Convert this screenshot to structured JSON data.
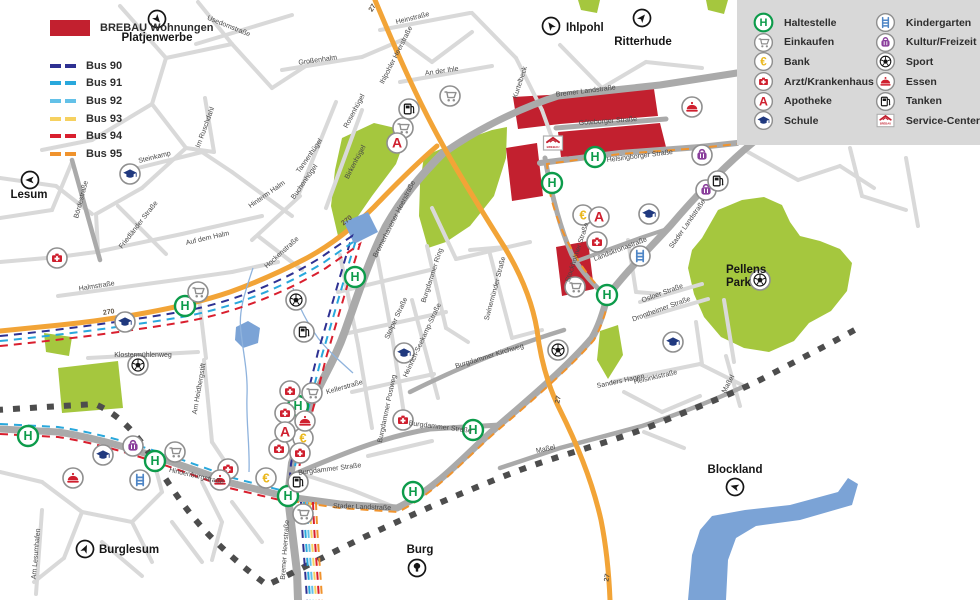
{
  "legend_left": {
    "brebau_label": "BREBAU Wohnungen",
    "brebau_color": "#c2202f",
    "bus_lines": [
      {
        "label": "Bus 90",
        "color": "#2e3192"
      },
      {
        "label": "Bus 91",
        "color": "#29a8dc"
      },
      {
        "label": "Bus 92",
        "color": "#63c1e8"
      },
      {
        "label": "Bus 93",
        "color": "#f6d160"
      },
      {
        "label": "Bus 94",
        "color": "#d91f2e"
      },
      {
        "label": "Bus 95",
        "color": "#f0932d"
      }
    ]
  },
  "legend_right": {
    "items": [
      {
        "icon": "haltestelle",
        "label": "Haltestelle"
      },
      {
        "icon": "einkaufen",
        "label": "Einkaufen"
      },
      {
        "icon": "bank",
        "label": "Bank"
      },
      {
        "icon": "arzt",
        "label": "Arzt/Krankenhaus"
      },
      {
        "icon": "apotheke",
        "label": "Apotheke"
      },
      {
        "icon": "schule",
        "label": "Schule"
      },
      {
        "icon": "kindergarten",
        "label": "Kindergarten"
      },
      {
        "icon": "kultur",
        "label": "Kultur/Freizeit"
      },
      {
        "icon": "sport",
        "label": "Sport"
      },
      {
        "icon": "essen",
        "label": "Essen"
      },
      {
        "icon": "tanken",
        "label": "Tanken"
      },
      {
        "icon": "brebau",
        "label": "Service-Center"
      }
    ]
  },
  "map": {
    "colors": {
      "park": "#a5c73e",
      "water": "#7ba3d6",
      "boundary": "#4d4d4d",
      "route": "#f2a437",
      "road_major": "#aaaaaa",
      "road_minor": "#d9d9d9",
      "panel": "#d8d8d8",
      "brebau": "#c2202f"
    },
    "places": [
      {
        "name": "Platjenwerbe",
        "x": 157,
        "y": 41,
        "anchor": "middle",
        "icon": "arrow",
        "ix": 157,
        "iy": 19,
        "rot": 140
      },
      {
        "name": "Ihlpohl",
        "x": 566,
        "y": 31,
        "anchor": "start",
        "icon": "arrow",
        "ix": 551,
        "iy": 26,
        "rot": -35
      },
      {
        "name": "Ritterhude",
        "x": 643,
        "y": 45,
        "anchor": "middle",
        "icon": "arrow",
        "ix": 642,
        "iy": 18,
        "rot": 40
      },
      {
        "name": "Lesum",
        "x": 29,
        "y": 198,
        "anchor": "middle",
        "icon": "arrow",
        "ix": 30,
        "iy": 180,
        "rot": -90
      },
      {
        "name": "Burglesum",
        "x": 99,
        "y": 553,
        "anchor": "start",
        "icon": "arrow",
        "ix": 85,
        "iy": 549,
        "rot": 25
      },
      {
        "name": "Burg",
        "x": 420,
        "y": 553,
        "anchor": "middle",
        "icon": "tree",
        "ix": 417,
        "iy": 568,
        "rot": 0
      },
      {
        "name": "Blockland",
        "x": 735,
        "y": 473,
        "anchor": "middle",
        "icon": "arrow",
        "ix": 735,
        "iy": 487,
        "rot": -75
      },
      {
        "name": "Pellens",
        "name2": "Park",
        "x": 726,
        "y": 273,
        "anchor": "start",
        "icon": "",
        "ix": 0,
        "iy": 0,
        "rot": 0
      }
    ],
    "streets": [
      {
        "t": "Usedomstraße",
        "x": 228,
        "y": 28,
        "r": 22
      },
      {
        "t": "Heinstraße",
        "x": 413,
        "y": 20,
        "r": -14
      },
      {
        "t": "An der Ihle",
        "x": 442,
        "y": 73,
        "r": -8
      },
      {
        "t": "Kurtelbeck",
        "x": 522,
        "y": 83,
        "r": -72
      },
      {
        "t": "Großenhalm",
        "x": 318,
        "y": 62,
        "r": -8
      },
      {
        "t": "Im Ruschdahl",
        "x": 207,
        "y": 128,
        "r": -70
      },
      {
        "t": "Rosenhügel",
        "x": 356,
        "y": 112,
        "r": -62
      },
      {
        "t": "Tannenhügel",
        "x": 311,
        "y": 157,
        "r": -55
      },
      {
        "t": "Birkenhügel",
        "x": 357,
        "y": 163,
        "r": -62
      },
      {
        "t": "Buchenhügel",
        "x": 306,
        "y": 183,
        "r": -55
      },
      {
        "t": "Steinkamp",
        "x": 155,
        "y": 159,
        "r": -14
      },
      {
        "t": "Bördestraße",
        "x": 83,
        "y": 200,
        "r": -75
      },
      {
        "t": "Friedländer Straße",
        "x": 140,
        "y": 226,
        "r": -52
      },
      {
        "t": "Hinterm Halm",
        "x": 268,
        "y": 196,
        "r": -35
      },
      {
        "t": "Auf dem Halm",
        "x": 208,
        "y": 240,
        "r": -13
      },
      {
        "t": "Hockenstraße",
        "x": 283,
        "y": 254,
        "r": -42
      },
      {
        "t": "Halmstraße",
        "x": 97,
        "y": 288,
        "r": -9
      },
      {
        "t": "Klostermühlenweg",
        "x": 143,
        "y": 357,
        "r": 0
      },
      {
        "t": "Am Heidbergstift",
        "x": 201,
        "y": 389,
        "r": -80
      },
      {
        "t": "Am Lesumhafen",
        "x": 38,
        "y": 554,
        "r": -85
      },
      {
        "t": "Hindenburgstraße",
        "x": 196,
        "y": 478,
        "r": 13
      },
      {
        "t": "Kellerstraße",
        "x": 345,
        "y": 389,
        "r": -16
      },
      {
        "t": "Burgdammer Straße",
        "x": 330,
        "y": 471,
        "r": -7
      },
      {
        "t": "Burgdammer Straße",
        "x": 440,
        "y": 429,
        "r": 7
      },
      {
        "t": "Burgdammer Postweg",
        "x": 389,
        "y": 409,
        "r": -78
      },
      {
        "t": "Burgdammer Ring",
        "x": 434,
        "y": 276,
        "r": -72
      },
      {
        "t": "Stolper Straße",
        "x": 398,
        "y": 319,
        "r": -65
      },
      {
        "t": "Heinrich-Seekamp-Straße",
        "x": 424,
        "y": 341,
        "r": -65
      },
      {
        "t": "Burgdammer Kirchweg",
        "x": 490,
        "y": 358,
        "r": -17
      },
      {
        "t": "Swinemünder Straße",
        "x": 497,
        "y": 289,
        "r": -75
      },
      {
        "t": "Bremerhavener Heerstraße",
        "x": 396,
        "y": 220,
        "r": -63
      },
      {
        "t": "Ihlpohler Heerstraße",
        "x": 398,
        "y": 56,
        "r": -63
      },
      {
        "t": "Bremer Heerstraße",
        "x": 287,
        "y": 550,
        "r": -86
      },
      {
        "t": "Bremer Landstraße",
        "x": 586,
        "y": 93,
        "r": -7
      },
      {
        "t": "Göteborger Straße",
        "x": 608,
        "y": 123,
        "r": -4
      },
      {
        "t": "Helsingborger Straße",
        "x": 640,
        "y": 158,
        "r": -7
      },
      {
        "t": "Stader Landstraße",
        "x": 689,
        "y": 225,
        "r": -55
      },
      {
        "t": "Stader Landstraße",
        "x": 362,
        "y": 509,
        "r": 2
      },
      {
        "t": "Stockholmer Straße",
        "x": 579,
        "y": 253,
        "r": -72
      },
      {
        "t": "Landskronastraße",
        "x": 621,
        "y": 251,
        "r": -21
      },
      {
        "t": "Osloer Straße",
        "x": 663,
        "y": 295,
        "r": -20
      },
      {
        "t": "Drontheimer Straße",
        "x": 662,
        "y": 311,
        "r": -20
      },
      {
        "t": "Helsinkistraße",
        "x": 656,
        "y": 379,
        "r": -13
      },
      {
        "t": "Sanders Hagen",
        "x": 621,
        "y": 383,
        "r": -12
      },
      {
        "t": "Maßel",
        "x": 546,
        "y": 451,
        "r": -12
      },
      {
        "t": "Maßel",
        "x": 730,
        "y": 385,
        "r": -62
      }
    ],
    "road_numbers": [
      {
        "t": "27",
        "x": 374,
        "y": 9,
        "r": -58
      },
      {
        "t": "270",
        "x": 109,
        "y": 314,
        "r": -8
      },
      {
        "t": "270",
        "x": 348,
        "y": 222,
        "r": -38
      },
      {
        "t": "27",
        "x": 560,
        "y": 400,
        "r": -78
      },
      {
        "t": "27",
        "x": 609,
        "y": 578,
        "r": -80
      }
    ],
    "pois": [
      {
        "t": "haltestelle",
        "x": 185,
        "y": 306
      },
      {
        "t": "haltestelle",
        "x": 355,
        "y": 277
      },
      {
        "t": "haltestelle",
        "x": 552,
        "y": 183
      },
      {
        "t": "haltestelle",
        "x": 595,
        "y": 157
      },
      {
        "t": "haltestelle",
        "x": 607,
        "y": 295
      },
      {
        "t": "haltestelle",
        "x": 28,
        "y": 436
      },
      {
        "t": "haltestelle",
        "x": 155,
        "y": 461
      },
      {
        "t": "haltestelle",
        "x": 298,
        "y": 406
      },
      {
        "t": "haltestelle",
        "x": 288,
        "y": 496
      },
      {
        "t": "haltestelle",
        "x": 473,
        "y": 430
      },
      {
        "t": "haltestelle",
        "x": 413,
        "y": 492
      },
      {
        "t": "einkaufen",
        "x": 450,
        "y": 96
      },
      {
        "t": "einkaufen",
        "x": 403,
        "y": 128
      },
      {
        "t": "einkaufen",
        "x": 198,
        "y": 292
      },
      {
        "t": "einkaufen",
        "x": 312,
        "y": 393
      },
      {
        "t": "einkaufen",
        "x": 175,
        "y": 452
      },
      {
        "t": "einkaufen",
        "x": 303,
        "y": 514
      },
      {
        "t": "einkaufen",
        "x": 575,
        "y": 287
      },
      {
        "t": "bank",
        "x": 583,
        "y": 215
      },
      {
        "t": "bank",
        "x": 303,
        "y": 438
      },
      {
        "t": "bank",
        "x": 266,
        "y": 478
      },
      {
        "t": "arzt",
        "x": 57,
        "y": 258
      },
      {
        "t": "arzt",
        "x": 290,
        "y": 391
      },
      {
        "t": "arzt",
        "x": 285,
        "y": 413
      },
      {
        "t": "arzt",
        "x": 279,
        "y": 449
      },
      {
        "t": "arzt",
        "x": 300,
        "y": 453
      },
      {
        "t": "arzt",
        "x": 228,
        "y": 469
      },
      {
        "t": "arzt",
        "x": 403,
        "y": 420
      },
      {
        "t": "arzt",
        "x": 597,
        "y": 242
      },
      {
        "t": "apotheke",
        "x": 397,
        "y": 143
      },
      {
        "t": "apotheke",
        "x": 285,
        "y": 432
      },
      {
        "t": "apotheke",
        "x": 599,
        "y": 217
      },
      {
        "t": "schule",
        "x": 130,
        "y": 174
      },
      {
        "t": "schule",
        "x": 125,
        "y": 322
      },
      {
        "t": "schule",
        "x": 103,
        "y": 455
      },
      {
        "t": "schule",
        "x": 404,
        "y": 353
      },
      {
        "t": "schule",
        "x": 649,
        "y": 214
      },
      {
        "t": "schule",
        "x": 673,
        "y": 342
      },
      {
        "t": "kindergarten",
        "x": 140,
        "y": 480
      },
      {
        "t": "kindergarten",
        "x": 640,
        "y": 256
      },
      {
        "t": "kultur",
        "x": 702,
        "y": 155
      },
      {
        "t": "kultur",
        "x": 706,
        "y": 190
      },
      {
        "t": "kultur",
        "x": 133,
        "y": 446
      },
      {
        "t": "sport",
        "x": 296,
        "y": 300
      },
      {
        "t": "sport",
        "x": 138,
        "y": 365
      },
      {
        "t": "sport",
        "x": 558,
        "y": 350
      },
      {
        "t": "sport",
        "x": 760,
        "y": 280
      },
      {
        "t": "essen",
        "x": 692,
        "y": 107
      },
      {
        "t": "essen",
        "x": 305,
        "y": 421
      },
      {
        "t": "essen",
        "x": 73,
        "y": 478
      },
      {
        "t": "essen",
        "x": 220,
        "y": 480
      },
      {
        "t": "tanken",
        "x": 409,
        "y": 109
      },
      {
        "t": "tanken",
        "x": 304,
        "y": 332
      },
      {
        "t": "tanken",
        "x": 298,
        "y": 482
      },
      {
        "t": "tanken",
        "x": 718,
        "y": 181
      },
      {
        "t": "brebau",
        "x": 553,
        "y": 143
      }
    ]
  }
}
